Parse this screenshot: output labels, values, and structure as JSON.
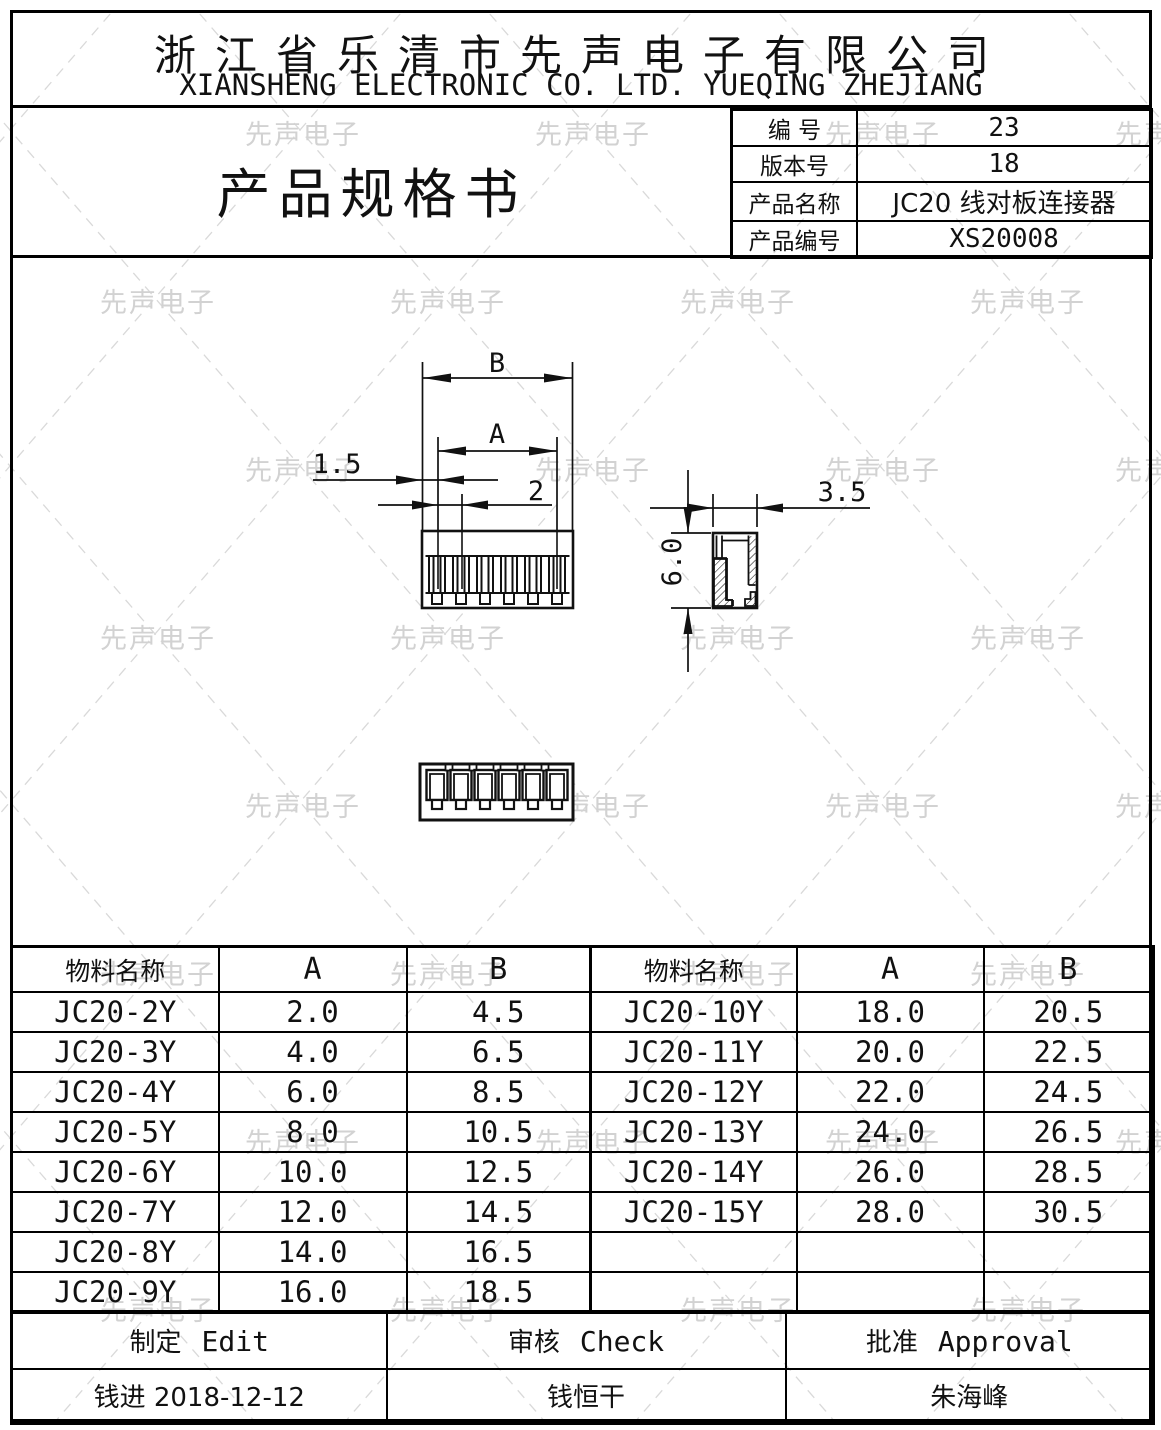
{
  "watermark": {
    "text": "先声电子",
    "color": "#d2d2d2",
    "line_color": "#d9d9d9"
  },
  "company": {
    "name_cn": "浙江省乐清市先声电子有限公司",
    "name_en": "XIANSHENG ELECTRONIC CO. LTD. YUEQING ZHEJIANG"
  },
  "doc": {
    "title": "产品规格书",
    "info": [
      {
        "label": "编  号",
        "value": "23"
      },
      {
        "label": "版本号",
        "value": "18"
      },
      {
        "label": "产品名称",
        "value": "JC20  线对板连接器"
      },
      {
        "label": "产品编号",
        "value": "XS20008"
      }
    ]
  },
  "drawing": {
    "dims": {
      "overall_width": "B",
      "pin_span": "A",
      "edge_offset": "1.5",
      "pitch": "2",
      "side_width": "3.5",
      "side_height": "6.0"
    }
  },
  "spec_table": {
    "headers": {
      "name": "物料名称",
      "a": "A",
      "b": "B"
    },
    "left_rows": [
      {
        "name": "JC20-2Y",
        "a": "2.0",
        "b": "4.5"
      },
      {
        "name": "JC20-3Y",
        "a": "4.0",
        "b": "6.5"
      },
      {
        "name": "JC20-4Y",
        "a": "6.0",
        "b": "8.5"
      },
      {
        "name": "JC20-5Y",
        "a": "8.0",
        "b": "10.5"
      },
      {
        "name": "JC20-6Y",
        "a": "10.0",
        "b": "12.5"
      },
      {
        "name": "JC20-7Y",
        "a": "12.0",
        "b": "14.5"
      },
      {
        "name": "JC20-8Y",
        "a": "14.0",
        "b": "16.5"
      },
      {
        "name": "JC20-9Y",
        "a": "16.0",
        "b": "18.5"
      }
    ],
    "right_rows": [
      {
        "name": "JC20-10Y",
        "a": "18.0",
        "b": "20.5"
      },
      {
        "name": "JC20-11Y",
        "a": "20.0",
        "b": "22.5"
      },
      {
        "name": "JC20-12Y",
        "a": "22.0",
        "b": "24.5"
      },
      {
        "name": "JC20-13Y",
        "a": "24.0",
        "b": "26.5"
      },
      {
        "name": "JC20-14Y",
        "a": "26.0",
        "b": "28.5"
      },
      {
        "name": "JC20-15Y",
        "a": "28.0",
        "b": "30.5"
      },
      {
        "name": "",
        "a": "",
        "b": ""
      },
      {
        "name": "",
        "a": "",
        "b": ""
      }
    ]
  },
  "approval": {
    "cells": [
      {
        "cn": "制定",
        "en": "Edit"
      },
      {
        "cn": "审核",
        "en": "Check"
      },
      {
        "cn": "批准",
        "en": "Approval"
      }
    ],
    "signers": [
      "钱进  2018-12-12",
      "钱恒干",
      "朱海峰"
    ]
  }
}
